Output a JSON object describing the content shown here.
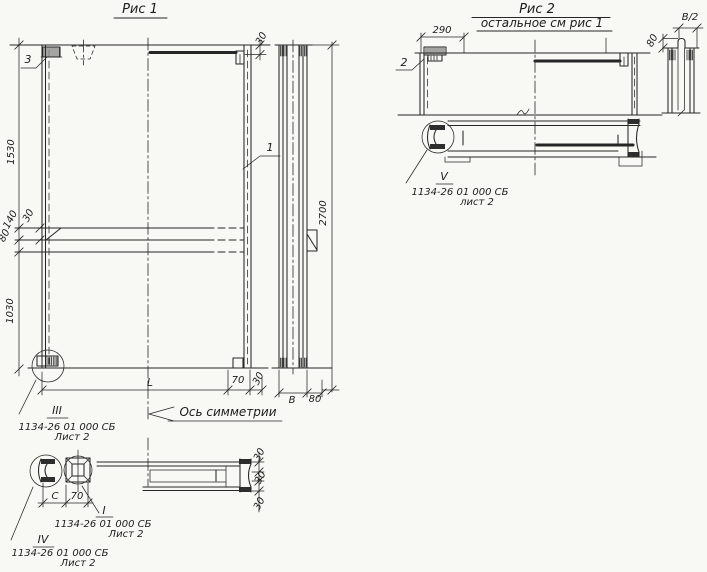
{
  "colors": {
    "paper": "#f8f8f5",
    "ink": "#262626"
  },
  "figure1": {
    "title": "Рис 1",
    "plan": {
      "callout_1": "1",
      "callout_3": "3",
      "dim_1530": "1530",
      "dim_140": "140",
      "dim_80": "80",
      "dim_1030": "1030",
      "dim_30_chamfer": "30",
      "dim_30_top": "30",
      "dim_L": "L",
      "dim_70": "70",
      "dim_30_bottom": "30",
      "axis_of_symmetry": "Ось симметрии"
    },
    "side": {
      "dim_2700": "2700",
      "dim_B": "В",
      "dim_80": "80"
    },
    "detail_III": {
      "mark": "III",
      "doc": "1134-26 01 000 СБ",
      "sheet": "Лист 2"
    },
    "section": {
      "dim_C": "С",
      "dim_70": "70",
      "dim_30_a": "30",
      "dim_30_b": "30",
      "dim_30_c": "30",
      "detail_I": {
        "mark": "I",
        "doc": "1134-26 01 000 СБ",
        "sheet": "Лист 2"
      },
      "detail_IV": {
        "mark": "IV",
        "doc": "1134-26 01 000 СБ",
        "sheet": "Лист 2"
      }
    }
  },
  "figure2": {
    "title": "Рис 2",
    "subtitle": "остальное см рис 1",
    "plan": {
      "dim_290": "290",
      "callout_2": "2"
    },
    "profile": {
      "dim_B_half": "В/2",
      "dim_80": "80"
    },
    "detail_V": {
      "mark": "V",
      "doc": "1134-26 01 000 СБ",
      "sheet": "лист 2"
    }
  }
}
